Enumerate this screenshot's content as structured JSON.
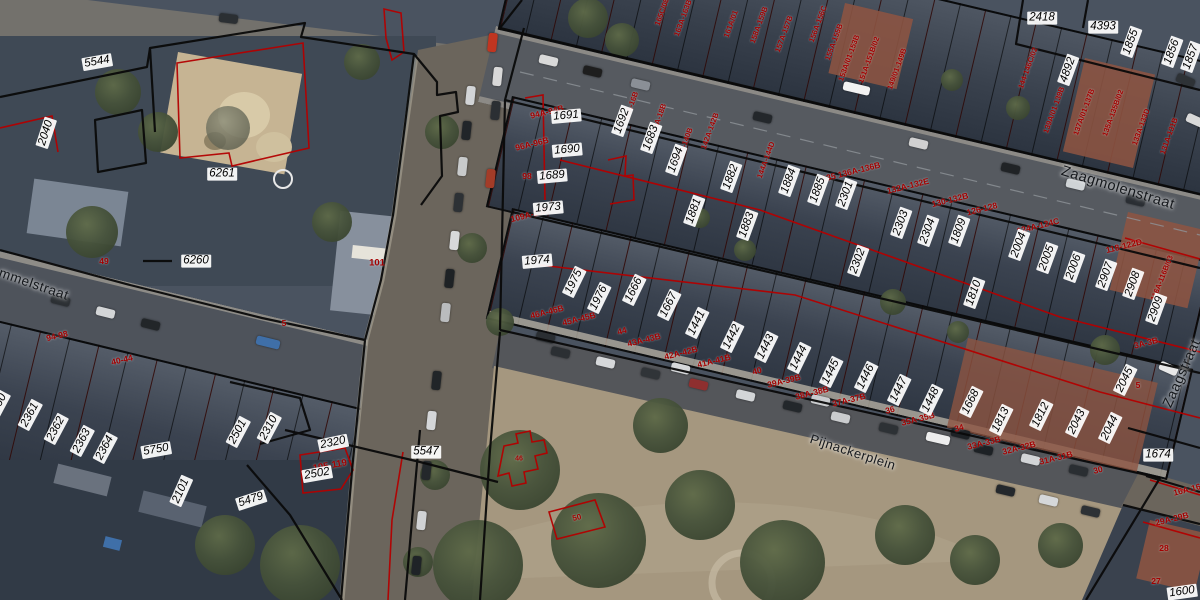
{
  "map_view": {
    "streets": [
      {
        "name": "Zaagmolenstraat",
        "x": 1118,
        "y": 188,
        "rot": 17,
        "size": 14.5
      },
      {
        "name": "Zaagstraat",
        "x": 1181,
        "y": 373,
        "rot": -66,
        "size": 14
      },
      {
        "name": "mmelstraat",
        "x": 34,
        "y": 284,
        "rot": 19,
        "size": 13.5
      },
      {
        "name": "Pijnackerplein",
        "x": 853,
        "y": 452,
        "rot": 18,
        "size": 13
      }
    ],
    "parcel_numbers": [
      {
        "t": "5544",
        "x": 97,
        "y": 62,
        "r": -10
      },
      {
        "t": "2040",
        "x": 46,
        "y": 133,
        "r": -72
      },
      {
        "t": "6261",
        "x": 222,
        "y": 174,
        "r": 0
      },
      {
        "t": "6260",
        "x": 196,
        "y": 261,
        "r": 0
      },
      {
        "t": "2360",
        "x": -2,
        "y": 406,
        "r": -62
      },
      {
        "t": "2361",
        "x": 30,
        "y": 415,
        "r": -62
      },
      {
        "t": "2362",
        "x": 56,
        "y": 429,
        "r": -62
      },
      {
        "t": "2363",
        "x": 82,
        "y": 441,
        "r": -62
      },
      {
        "t": "2364",
        "x": 105,
        "y": 448,
        "r": -62
      },
      {
        "t": "5750",
        "x": 156,
        "y": 450,
        "r": -10
      },
      {
        "t": "2501",
        "x": 238,
        "y": 432,
        "r": -62
      },
      {
        "t": "2310",
        "x": 269,
        "y": 428,
        "r": -62
      },
      {
        "t": "2320",
        "x": 333,
        "y": 443,
        "r": -12
      },
      {
        "t": "2502",
        "x": 317,
        "y": 474,
        "r": -10
      },
      {
        "t": "5479",
        "x": 251,
        "y": 500,
        "r": -18
      },
      {
        "t": "2101",
        "x": 181,
        "y": 491,
        "r": -66
      },
      {
        "t": "5547",
        "x": 426,
        "y": 452,
        "r": 0
      },
      {
        "t": "1691",
        "x": 566,
        "y": 116,
        "r": -5
      },
      {
        "t": "1690",
        "x": 567,
        "y": 150,
        "r": -5
      },
      {
        "t": "1689",
        "x": 552,
        "y": 176,
        "r": -5
      },
      {
        "t": "1973",
        "x": 548,
        "y": 208,
        "r": -5
      },
      {
        "t": "1974",
        "x": 537,
        "y": 261,
        "r": -5
      },
      {
        "t": "1692",
        "x": 622,
        "y": 121,
        "r": -70
      },
      {
        "t": "1683",
        "x": 651,
        "y": 138,
        "r": -70
      },
      {
        "t": "1694",
        "x": 676,
        "y": 160,
        "r": -70
      },
      {
        "t": "1882",
        "x": 731,
        "y": 177,
        "r": -70
      },
      {
        "t": "1881",
        "x": 694,
        "y": 211,
        "r": -70
      },
      {
        "t": "1883",
        "x": 747,
        "y": 225,
        "r": -70
      },
      {
        "t": "1884",
        "x": 789,
        "y": 181,
        "r": -70
      },
      {
        "t": "1885",
        "x": 818,
        "y": 190,
        "r": -70
      },
      {
        "t": "2301",
        "x": 846,
        "y": 194,
        "r": -70
      },
      {
        "t": "2302",
        "x": 858,
        "y": 261,
        "r": -70
      },
      {
        "t": "2303",
        "x": 901,
        "y": 223,
        "r": -70
      },
      {
        "t": "2304",
        "x": 928,
        "y": 231,
        "r": -70
      },
      {
        "t": "1809",
        "x": 959,
        "y": 231,
        "r": -70
      },
      {
        "t": "1810",
        "x": 974,
        "y": 293,
        "r": -70
      },
      {
        "t": "2004",
        "x": 1019,
        "y": 245,
        "r": -70
      },
      {
        "t": "2005",
        "x": 1047,
        "y": 258,
        "r": -70
      },
      {
        "t": "2006",
        "x": 1074,
        "y": 267,
        "r": -70
      },
      {
        "t": "2907",
        "x": 1106,
        "y": 275,
        "r": -70
      },
      {
        "t": "2908",
        "x": 1133,
        "y": 284,
        "r": -70
      },
      {
        "t": "2909",
        "x": 1156,
        "y": 309,
        "r": -70
      },
      {
        "t": "1975",
        "x": 574,
        "y": 282,
        "r": -64
      },
      {
        "t": "1976",
        "x": 599,
        "y": 298,
        "r": -64
      },
      {
        "t": "1666",
        "x": 634,
        "y": 290,
        "r": -64
      },
      {
        "t": "1667",
        "x": 669,
        "y": 305,
        "r": -64
      },
      {
        "t": "1441",
        "x": 697,
        "y": 323,
        "r": -64
      },
      {
        "t": "1442",
        "x": 732,
        "y": 337,
        "r": -64
      },
      {
        "t": "1443",
        "x": 766,
        "y": 347,
        "r": -64
      },
      {
        "t": "1444",
        "x": 799,
        "y": 358,
        "r": -64
      },
      {
        "t": "1445",
        "x": 831,
        "y": 372,
        "r": -64
      },
      {
        "t": "1446",
        "x": 866,
        "y": 377,
        "r": -64
      },
      {
        "t": "1447",
        "x": 899,
        "y": 390,
        "r": -64
      },
      {
        "t": "1448",
        "x": 931,
        "y": 400,
        "r": -64
      },
      {
        "t": "1668",
        "x": 971,
        "y": 402,
        "r": -64
      },
      {
        "t": "1813",
        "x": 1001,
        "y": 420,
        "r": -64
      },
      {
        "t": "1812",
        "x": 1041,
        "y": 415,
        "r": -64
      },
      {
        "t": "2043",
        "x": 1077,
        "y": 422,
        "r": -64
      },
      {
        "t": "2044",
        "x": 1110,
        "y": 428,
        "r": -64
      },
      {
        "t": "2045",
        "x": 1125,
        "y": 380,
        "r": -64
      },
      {
        "t": "1674",
        "x": 1158,
        "y": 455,
        "r": 0
      },
      {
        "t": "1600",
        "x": 1182,
        "y": 592,
        "r": -8
      },
      {
        "t": "2418",
        "x": 1042,
        "y": 18,
        "r": 0
      },
      {
        "t": "4393",
        "x": 1103,
        "y": 27,
        "r": 0
      },
      {
        "t": "1855",
        "x": 1131,
        "y": 42,
        "r": -70
      },
      {
        "t": "1856",
        "x": 1172,
        "y": 52,
        "r": -70
      },
      {
        "t": "1857",
        "x": 1191,
        "y": 57,
        "r": -70
      },
      {
        "t": "4892",
        "x": 1068,
        "y": 70,
        "r": -70
      }
    ],
    "house_numbers": [
      {
        "t": "49",
        "x": 104,
        "y": 261,
        "r": 0
      },
      {
        "t": "94-98",
        "x": 57,
        "y": 336,
        "r": -13
      },
      {
        "t": "40-44",
        "x": 122,
        "y": 360,
        "r": -13
      },
      {
        "t": "5",
        "x": 284,
        "y": 323,
        "r": 0
      },
      {
        "t": "101",
        "x": 377,
        "y": 263,
        "r": 0,
        "size": 9.5
      },
      {
        "t": "105-119",
        "x": 330,
        "y": 466,
        "r": -10,
        "size": 9.5
      },
      {
        "t": "109A-102",
        "x": 529,
        "y": 215,
        "r": -14
      },
      {
        "t": "94A-94B",
        "x": 547,
        "y": 112,
        "r": -14
      },
      {
        "t": "96A-96B",
        "x": 532,
        "y": 144,
        "r": -14
      },
      {
        "t": "98",
        "x": 527,
        "y": 176,
        "r": 0
      },
      {
        "t": "46A-46B",
        "x": 547,
        "y": 312,
        "r": -14
      },
      {
        "t": "45A-45B",
        "x": 579,
        "y": 319,
        "r": -14
      },
      {
        "t": "44",
        "x": 622,
        "y": 331,
        "r": -14
      },
      {
        "t": "43A-43B",
        "x": 644,
        "y": 340,
        "r": -14
      },
      {
        "t": "42A-42B",
        "x": 681,
        "y": 353,
        "r": -14
      },
      {
        "t": "41A-41B",
        "x": 714,
        "y": 361,
        "r": -14
      },
      {
        "t": "40",
        "x": 757,
        "y": 371,
        "r": -14
      },
      {
        "t": "39A-39B",
        "x": 784,
        "y": 381,
        "r": -14
      },
      {
        "t": "38A-38B",
        "x": 812,
        "y": 393,
        "r": -14
      },
      {
        "t": "37A-37B",
        "x": 849,
        "y": 400,
        "r": -14
      },
      {
        "t": "36",
        "x": 890,
        "y": 410,
        "r": -14
      },
      {
        "t": "35A-35B",
        "x": 918,
        "y": 419,
        "r": -14
      },
      {
        "t": "34",
        "x": 959,
        "y": 428,
        "r": -14
      },
      {
        "t": "33A-33B",
        "x": 984,
        "y": 443,
        "r": -14
      },
      {
        "t": "32A-32B",
        "x": 1019,
        "y": 448,
        "r": -14
      },
      {
        "t": "31A-31B",
        "x": 1056,
        "y": 458,
        "r": -14
      },
      {
        "t": "30",
        "x": 1098,
        "y": 470,
        "r": -14
      },
      {
        "t": "29A-29B",
        "x": 1172,
        "y": 519,
        "r": -14
      },
      {
        "t": "28",
        "x": 1164,
        "y": 548,
        "r": 0
      },
      {
        "t": "27",
        "x": 1156,
        "y": 581,
        "r": 0
      },
      {
        "t": "16A-16B",
        "x": 1190,
        "y": 489,
        "r": -14
      },
      {
        "t": "3A-3B",
        "x": 1146,
        "y": 343,
        "r": -14
      },
      {
        "t": "5",
        "x": 1138,
        "y": 385,
        "r": 0
      },
      {
        "t": "118-122D",
        "x": 1124,
        "y": 246,
        "r": -14
      },
      {
        "t": "116A-116B/03",
        "x": 1162,
        "y": 278,
        "r": -68,
        "size": 7.5
      },
      {
        "t": "124A-124C",
        "x": 1038,
        "y": 226,
        "r": -14
      },
      {
        "t": "126-128",
        "x": 982,
        "y": 209,
        "r": -14
      },
      {
        "t": "130-132B",
        "x": 950,
        "y": 200,
        "r": -14
      },
      {
        "t": "132A-132E",
        "x": 908,
        "y": 186,
        "r": -14
      },
      {
        "t": "135 136A-136B",
        "x": 851,
        "y": 172,
        "r": -14
      },
      {
        "t": "144A-144D",
        "x": 766,
        "y": 160,
        "r": -70,
        "size": 7.5
      },
      {
        "t": "142A-142B",
        "x": 710,
        "y": 131,
        "r": -70,
        "size": 7.5
      },
      {
        "t": "140A-140B",
        "x": 684,
        "y": 146,
        "r": -70,
        "size": 7.5
      },
      {
        "t": "18A-18B",
        "x": 659,
        "y": 118,
        "r": -70,
        "size": 7.5
      },
      {
        "t": "16A-16B",
        "x": 631,
        "y": 106,
        "r": -70,
        "size": 7.5
      },
      {
        "t": "165C/08",
        "x": 662,
        "y": 12,
        "r": -70,
        "size": 7.5
      },
      {
        "t": "163A-163B",
        "x": 683,
        "y": 18,
        "r": -70,
        "size": 7.5
      },
      {
        "t": "161A/01",
        "x": 731,
        "y": 24,
        "r": -70,
        "size": 7.5
      },
      {
        "t": "158A-159B",
        "x": 759,
        "y": 25,
        "r": -70,
        "size": 7.5
      },
      {
        "t": "157A-157B",
        "x": 784,
        "y": 34,
        "r": -70,
        "size": 7.5
      },
      {
        "t": "156A-156C",
        "x": 818,
        "y": 24,
        "r": -70,
        "size": 7.5
      },
      {
        "t": "155A-155B",
        "x": 834,
        "y": 42,
        "r": -70,
        "size": 7.5
      },
      {
        "t": "153A/01-153B",
        "x": 849,
        "y": 58,
        "r": -70,
        "size": 7.5
      },
      {
        "t": "151A-151B/02",
        "x": 869,
        "y": 60,
        "r": -70,
        "size": 7.5
      },
      {
        "t": "149/01-149B",
        "x": 897,
        "y": 69,
        "r": -70,
        "size": 7.5
      },
      {
        "t": "144-146C/02",
        "x": 1028,
        "y": 68,
        "r": -70,
        "size": 7.5
      },
      {
        "t": "139A/01-139B",
        "x": 1054,
        "y": 110,
        "r": -70,
        "size": 7.5
      },
      {
        "t": "137A/01-137B",
        "x": 1084,
        "y": 112,
        "r": -70,
        "size": 7.5
      },
      {
        "t": "135A-135B/02",
        "x": 1113,
        "y": 113,
        "r": -70,
        "size": 7.5
      },
      {
        "t": "133A-133D",
        "x": 1141,
        "y": 127,
        "r": -70,
        "size": 7.5
      },
      {
        "t": "131A-131B",
        "x": 1169,
        "y": 136,
        "r": -70,
        "size": 7.5
      },
      {
        "t": "46",
        "x": 519,
        "y": 459,
        "r": 0,
        "size": 7
      },
      {
        "t": "50",
        "x": 577,
        "y": 518,
        "r": -14,
        "size": 8
      }
    ],
    "colors": {
      "parcel_line": "#0a0a0a",
      "cadastral_red_line": "#b30000",
      "parcel_label_color": "#000000",
      "parcel_label_bg": "#ffffff",
      "house_number_color": "#a30000",
      "street_label_color": "#15181c"
    }
  }
}
